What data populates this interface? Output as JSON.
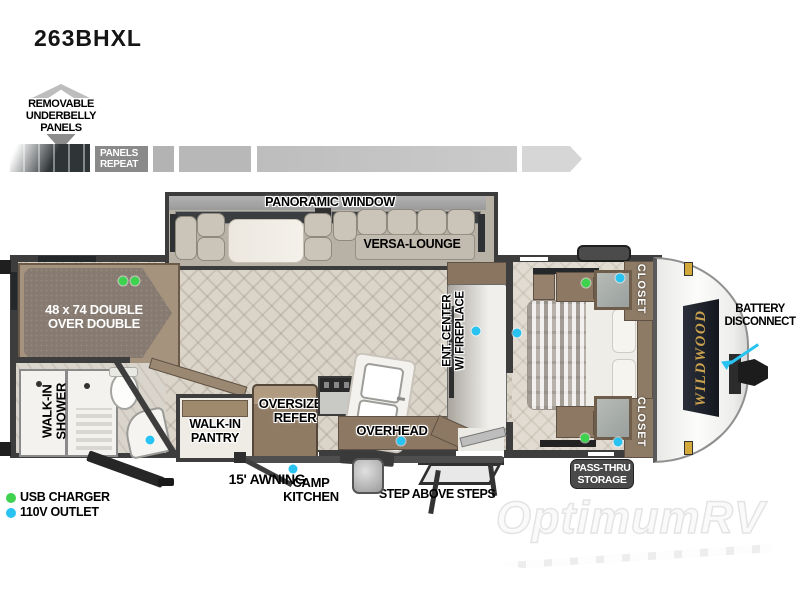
{
  "title": "263BHXL",
  "underbelly": {
    "label": "REMOVABLE\nUNDERBELLY\nPANELS",
    "panels_repeat": "PANELS\nREPEAT"
  },
  "labels": {
    "panoramic_window": "PANORAMIC WINDOW",
    "versa_lounge": "VERSA-LOUNGE",
    "bunk": "48 x 74 DOUBLE\nOVER DOUBLE",
    "walk_in_shower": "WALK-IN\nSHOWER",
    "ent_center": "ENT. CENTER\nW/ FIREPLACE",
    "closet_top": "CLOSET",
    "closet_bottom": "CLOSET",
    "walk_in_pantry": "WALK-IN\nPANTRY",
    "oversized_refer": "OVERSIZED\nREFER",
    "overhead": "OVERHEAD",
    "battery_disconnect": "BATTERY\nDISCONNECT",
    "pass_thru_storage": "PASS-THRU\nSTORAGE",
    "awning": "15' AWNING",
    "camp_kitchen": "CAMP\nKITCHEN",
    "step_above_steps": "STEP ABOVE STEPS",
    "brand_logo": "WILDWOOD"
  },
  "legend": {
    "items": [
      {
        "key": "usb",
        "label": "USB CHARGER",
        "color": "#3ed24f"
      },
      {
        "key": "outlet",
        "label": "110V OUTLET",
        "color": "#29c3f2"
      }
    ]
  },
  "markers": {
    "usb": [
      [
        123,
        281
      ],
      [
        135,
        281
      ],
      [
        586,
        283
      ],
      [
        585,
        438
      ]
    ],
    "outlet": [
      [
        150,
        440
      ],
      [
        293,
        469
      ],
      [
        401,
        441
      ],
      [
        476,
        331
      ],
      [
        517,
        333
      ],
      [
        620,
        278
      ],
      [
        618,
        442
      ]
    ]
  },
  "watermark": "OptimumRV"
}
